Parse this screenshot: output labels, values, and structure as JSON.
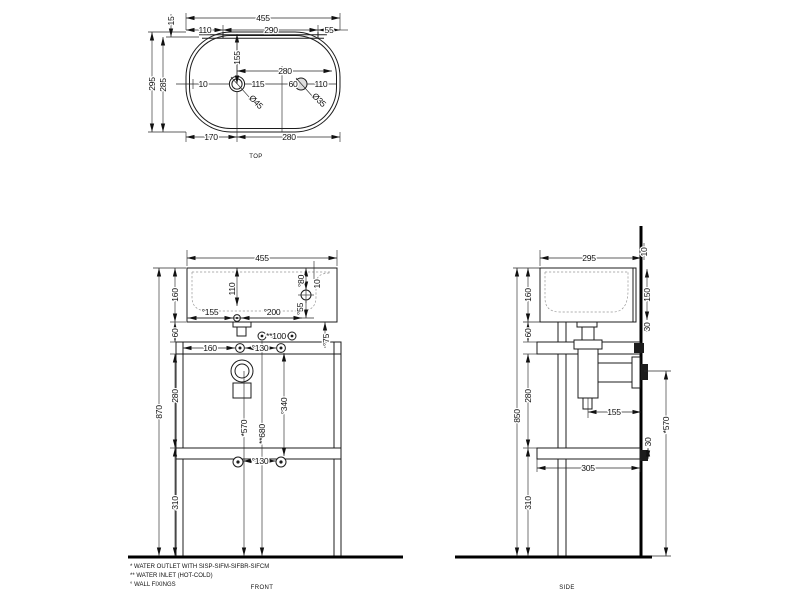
{
  "drawing": {
    "views": {
      "top": {
        "label": "TOP",
        "dims": [
          {
            "text": "455",
            "x": 263,
            "y": 21,
            "rot": 0
          },
          {
            "text": "15",
            "x": 174,
            "y": 21,
            "rot": -90
          },
          {
            "text": "110",
            "x": 205,
            "y": 33,
            "rot": 0
          },
          {
            "text": "290",
            "x": 271,
            "y": 33,
            "rot": 0
          },
          {
            "text": "55",
            "x": 329,
            "y": 33,
            "rot": 0
          },
          {
            "text": "295",
            "x": 155,
            "y": 84,
            "rot": -90
          },
          {
            "text": "285",
            "x": 166,
            "y": 85,
            "rot": -90
          },
          {
            "text": "155",
            "x": 240,
            "y": 58,
            "rot": -90
          },
          {
            "text": "10",
            "x": 203,
            "y": 87,
            "rot": 0
          },
          {
            "text": "115",
            "x": 258,
            "y": 87,
            "rot": 0
          },
          {
            "text": "280",
            "x": 285,
            "y": 74,
            "rot": 0
          },
          {
            "text": "60",
            "x": 293,
            "y": 87,
            "rot": 0
          },
          {
            "text": "110",
            "x": 321,
            "y": 87,
            "rot": 0
          },
          {
            "text": "Ø45",
            "x": 254,
            "y": 104,
            "rot": 45
          },
          {
            "text": "Ø35",
            "x": 317,
            "y": 102,
            "rot": 45
          },
          {
            "text": "170",
            "x": 211,
            "y": 140,
            "rot": 0
          },
          {
            "text": "280",
            "x": 289,
            "y": 140,
            "rot": 0
          }
        ]
      },
      "front": {
        "label": "FRONT",
        "dims": [
          {
            "text": "455",
            "x": 262,
            "y": 261,
            "rot": 0
          },
          {
            "text": "160",
            "x": 178,
            "y": 295,
            "rot": -90
          },
          {
            "text": "110",
            "x": 235,
            "y": 289,
            "rot": -90
          },
          {
            "text": "°80",
            "x": 304,
            "y": 281,
            "rot": -90
          },
          {
            "text": "10",
            "x": 320,
            "y": 284,
            "rot": -90
          },
          {
            "text": "°155",
            "x": 210,
            "y": 315,
            "rot": 0
          },
          {
            "text": "°200",
            "x": 272,
            "y": 315,
            "rot": 0
          },
          {
            "text": "°55",
            "x": 303,
            "y": 309,
            "rot": -90
          },
          {
            "text": "60",
            "x": 178,
            "y": 333,
            "rot": -90
          },
          {
            "text": "**100",
            "x": 276,
            "y": 339,
            "rot": 0
          },
          {
            "text": "°75",
            "x": 329,
            "y": 340,
            "rot": -90
          },
          {
            "text": "160",
            "x": 210,
            "y": 351,
            "rot": 0
          },
          {
            "text": "°130",
            "x": 260,
            "y": 351,
            "rot": 0
          },
          {
            "text": "870",
            "x": 162,
            "y": 412,
            "rot": -90
          },
          {
            "text": "280",
            "x": 178,
            "y": 396,
            "rot": -90
          },
          {
            "text": "*570",
            "x": 247,
            "y": 428,
            "rot": -90
          },
          {
            "text": "**680",
            "x": 265,
            "y": 434,
            "rot": -90
          },
          {
            "text": "°340",
            "x": 287,
            "y": 406,
            "rot": -90
          },
          {
            "text": "°130",
            "x": 260,
            "y": 464,
            "rot": 0
          },
          {
            "text": "310",
            "x": 178,
            "y": 503,
            "rot": -90
          }
        ]
      },
      "side": {
        "label": "SIDE",
        "dims": [
          {
            "text": "295",
            "x": 589,
            "y": 261,
            "rot": 0
          },
          {
            "text": "10",
            "x": 647,
            "y": 252,
            "rot": -90
          },
          {
            "text": "160",
            "x": 531,
            "y": 295,
            "rot": -90
          },
          {
            "text": "150",
            "x": 650,
            "y": 295,
            "rot": -90
          },
          {
            "text": "60",
            "x": 531,
            "y": 333,
            "rot": -90
          },
          {
            "text": "30",
            "x": 650,
            "y": 327,
            "rot": -90
          },
          {
            "text": "280",
            "x": 531,
            "y": 396,
            "rot": -90
          },
          {
            "text": "850",
            "x": 520,
            "y": 416,
            "rot": -90
          },
          {
            "text": "155",
            "x": 614,
            "y": 415,
            "rot": 0
          },
          {
            "text": "*570",
            "x": 669,
            "y": 425,
            "rot": -90
          },
          {
            "text": "30",
            "x": 651,
            "y": 442,
            "rot": -90
          },
          {
            "text": "305",
            "x": 588,
            "y": 471,
            "rot": 0
          },
          {
            "text": "310",
            "x": 531,
            "y": 503,
            "rot": -90
          }
        ]
      }
    },
    "footnotes": [
      "*  WATER OUTLET WITH SISP-SIFM-SIFBR-SIFCM",
      "** WATER INLET  (HOT-COLD)",
      "°  WALL FIXINGS"
    ],
    "colors": {
      "line": "#1c1c1c",
      "background": "#ffffff"
    }
  }
}
